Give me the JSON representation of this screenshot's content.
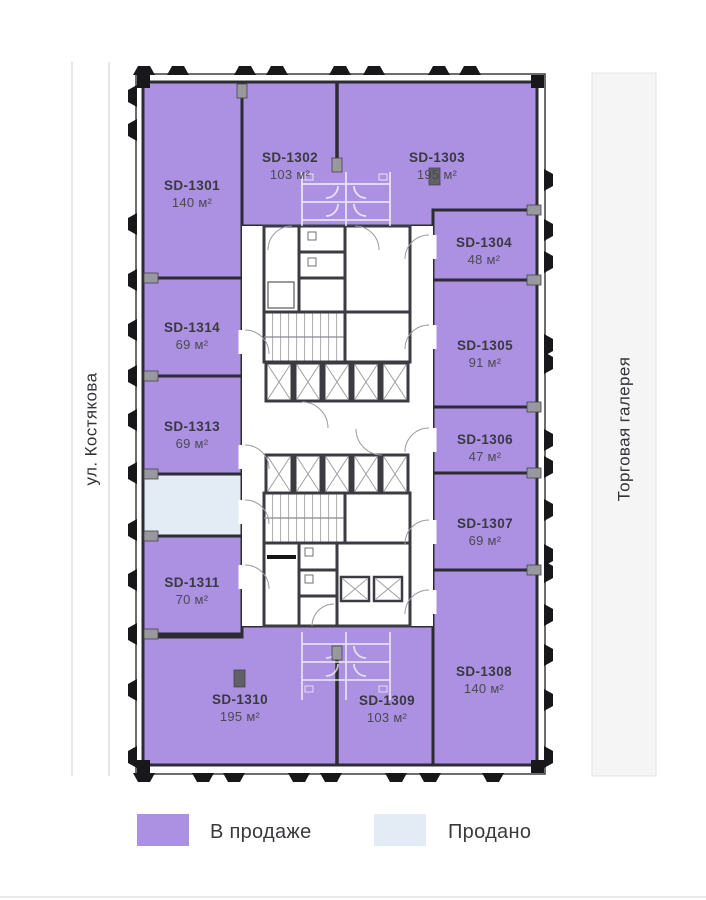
{
  "floor_plan": {
    "street_label": "ул. Костякова",
    "gallery_label": "Торговая галерея",
    "colors": {
      "available": "#ac90e2",
      "sold": "#e3ebf4"
    },
    "units": {
      "u1301": {
        "id": "SD-1301",
        "area": "140 м²",
        "status": "available"
      },
      "u1302": {
        "id": "SD-1302",
        "area": "103 м²",
        "status": "available"
      },
      "u1303": {
        "id": "SD-1303",
        "area": "195 м²",
        "status": "available"
      },
      "u1304": {
        "id": "SD-1304",
        "area": "48 м²",
        "status": "available"
      },
      "u1305": {
        "id": "SD-1305",
        "area": "91 м²",
        "status": "available"
      },
      "u1306": {
        "id": "SD-1306",
        "area": "47 м²",
        "status": "available"
      },
      "u1307": {
        "id": "SD-1307",
        "area": "69 м²",
        "status": "available"
      },
      "u1308": {
        "id": "SD-1308",
        "area": "140 м²",
        "status": "available"
      },
      "u1309": {
        "id": "SD-1309",
        "area": "103 м²",
        "status": "available"
      },
      "u1310": {
        "id": "SD-1310",
        "area": "195 м²",
        "status": "available"
      },
      "u1311": {
        "id": "SD-1311",
        "area": "70 м²",
        "status": "available"
      },
      "u1313": {
        "id": "SD-1313",
        "area": "69 м²",
        "status": "available"
      },
      "u1314": {
        "id": "SD-1314",
        "area": "69 м²",
        "status": "available"
      },
      "sold_unit": {
        "status": "sold"
      }
    },
    "legend": [
      {
        "label": "В продаже",
        "color": "#ac90e2"
      },
      {
        "label": "Продано",
        "color": "#e3ebf4"
      }
    ]
  }
}
